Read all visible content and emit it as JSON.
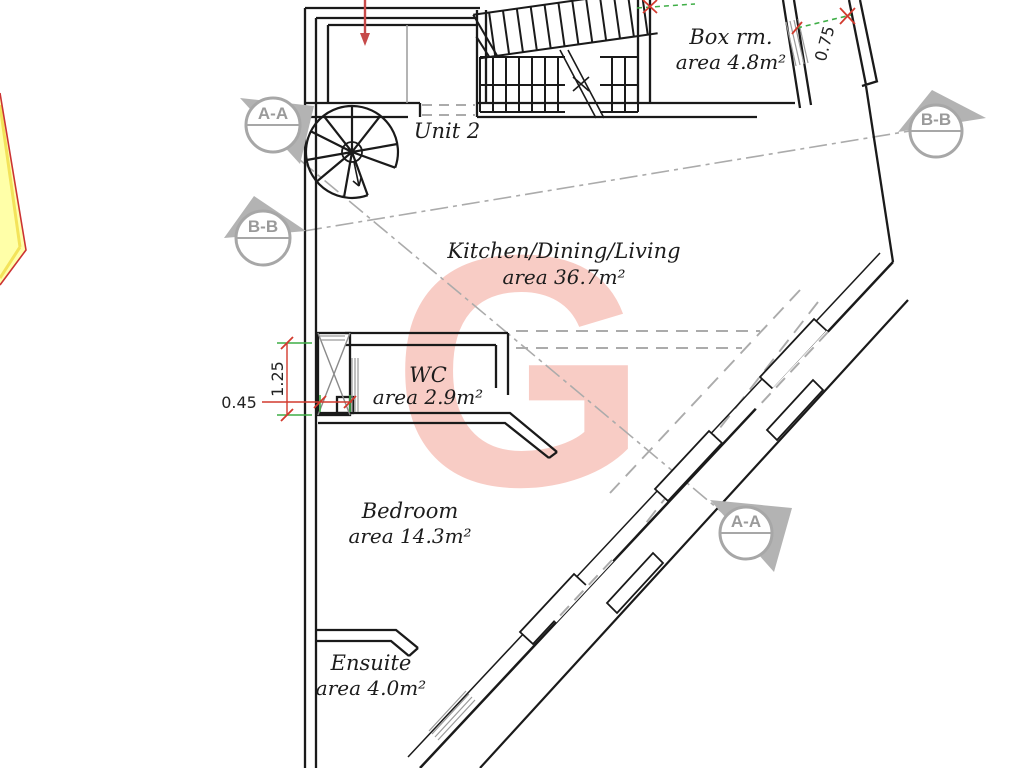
{
  "plan": {
    "unit_label": "Unit 2",
    "watermark": "G",
    "rooms": [
      {
        "id": "box-room",
        "name": "Box rm.",
        "area": "area 4.8m²"
      },
      {
        "id": "kitchen-dining-living",
        "name": "Kitchen/Dining/Living",
        "area": "area 36.7m²"
      },
      {
        "id": "wc",
        "name": "WC",
        "area": "area 2.9m²"
      },
      {
        "id": "bedroom",
        "name": "Bedroom",
        "area": "area 14.3m²"
      },
      {
        "id": "ensuite",
        "name": "Ensuite",
        "area": "area 4.0m²"
      }
    ],
    "dimensions": [
      {
        "id": "dim-shaft-width-top",
        "label": "0.75"
      },
      {
        "id": "dim-wc-height",
        "label": "1.25"
      },
      {
        "id": "dim-shaft-width",
        "label": "0.45"
      }
    ],
    "section_markers": [
      {
        "id": "section-a-top-left",
        "label": "A-A"
      },
      {
        "id": "section-b-left",
        "label": "B-B"
      },
      {
        "id": "section-b-right",
        "label": "B-B"
      },
      {
        "id": "section-a-bottom",
        "label": "A-A"
      }
    ],
    "colors": {
      "wall": "#1a1a1a",
      "section_gray": "#a8a8a8",
      "dimension_red": "#d23a2e",
      "extension_green": "#3fae47",
      "watermark_pink": "#f8ccc5",
      "highlight_yellow": "#ffffa8",
      "highlight_red": "#cc3333"
    }
  }
}
